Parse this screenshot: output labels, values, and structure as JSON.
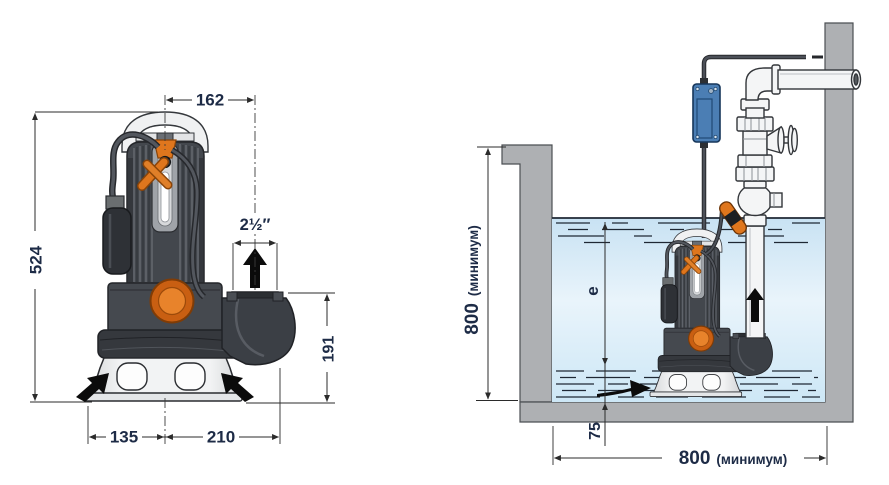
{
  "view": "submersible-pump-dimensions-and-installation-diagram",
  "colors": {
    "dimension_text": "#1d2b46",
    "dimension_line": "#2b2b2b",
    "pump_body_dark": "#3f434a",
    "pump_orange": "#df761d",
    "water_blue": "#cfe7f6",
    "wall_gray": "#aeb0b3",
    "junction_box_blue": "#4b7eb4",
    "pipe_white": "#f4f5f6"
  },
  "left_view": {
    "dimensions": {
      "outlet_offset": "162",
      "total_height": "524",
      "outlet_size": "2½″",
      "outlet_height": "191",
      "base_left": "135",
      "base_right": "210"
    },
    "icons": {
      "outlet_flow": "up-arrow",
      "suction_flow": "diagonal-arrows"
    }
  },
  "right_view": {
    "dimensions": {
      "pit_depth_value": "800",
      "pit_depth_qualifier": "(минимум)",
      "pit_width_value": "800",
      "pit_width_qualifier": "(минимум)",
      "water_level": "e",
      "min_submersion": "75"
    },
    "icons": {
      "discharge_flow": "up-arrow",
      "inflow": "right-arrow"
    }
  }
}
